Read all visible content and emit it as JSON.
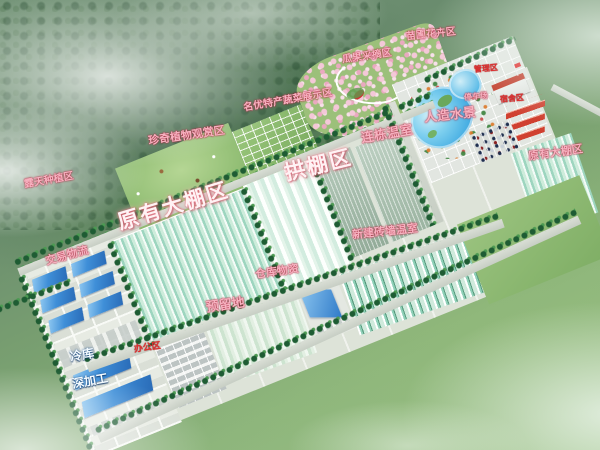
{
  "regions": {
    "open_field": {
      "label": "露天种植区"
    },
    "rare_plants": {
      "label": "珍奇植物观赏区"
    },
    "vegetable_show": {
      "label": "名优特产蔬菜展示区"
    },
    "fruit_picking": {
      "label": "瓜果采摘区"
    },
    "nursery_flowers": {
      "label": "苗圃花卉区"
    },
    "admin": {
      "label": "管理区"
    },
    "parking": {
      "label": "停车场"
    },
    "dormitory": {
      "label": "宿舍区"
    },
    "water_feature": {
      "label": "人造水景"
    },
    "multi_span": {
      "label": "连栋温室"
    },
    "arch_sheds": {
      "label": "拱棚区"
    },
    "existing_main": {
      "label": "原有大棚区"
    },
    "existing_east": {
      "label": "原有大棚区"
    },
    "new_brick": {
      "label": "新建砖墙温室"
    },
    "trade_logistics": {
      "label": "交易物流"
    },
    "warehouse": {
      "label": "仓库物资"
    },
    "reserved": {
      "label": "预留地"
    },
    "office": {
      "label": "办公区"
    },
    "cold_storage": {
      "label": "冷库"
    },
    "processing": {
      "label": "深加工"
    }
  },
  "colors": {
    "label_pink": "#f6b2c0",
    "label_red": "#e03030",
    "label_white": "#fff2f4",
    "water_blue": "#3aa6e0",
    "roof_blue": "#3f8fd8",
    "roof_red": "#c8382a",
    "greenhouse_teal": "#9dd5bf",
    "lawn_green": "#8fbc72"
  }
}
